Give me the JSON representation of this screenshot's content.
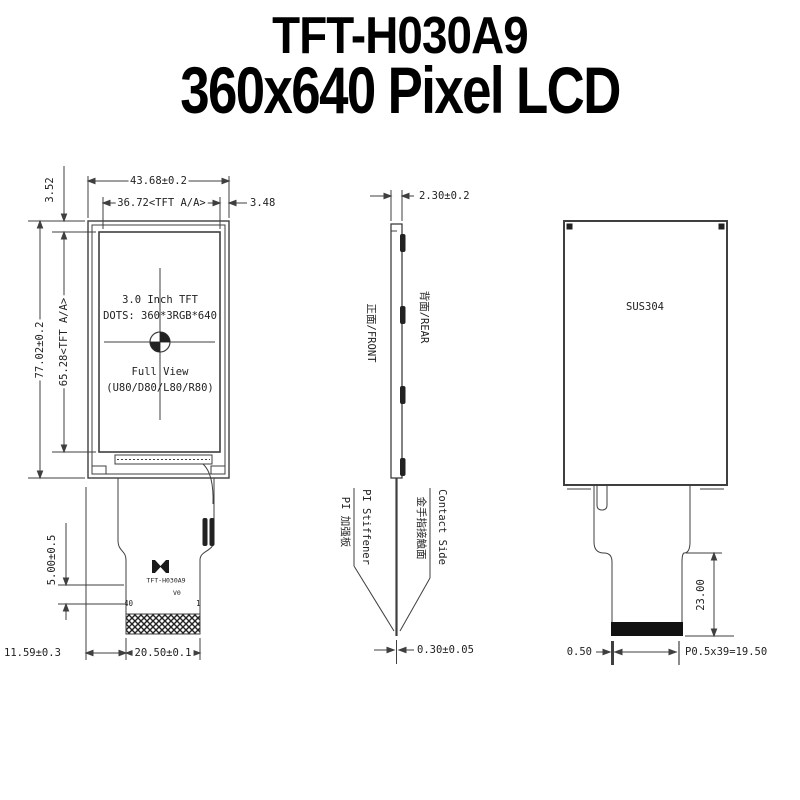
{
  "title": {
    "line1": "TFT-H030A9",
    "line2": "360x640 Pixel LCD"
  },
  "colors": {
    "background": "#ffffff",
    "line": "#3f3f3f",
    "text": "#222222",
    "title": "#000000"
  },
  "front_view": {
    "dim_width_outer": "43.68±0.2",
    "dim_width_aa": "36.72<TFT A/A>",
    "dim_gap_right": "3.48",
    "dim_gap_top": "3.52",
    "dim_height_outer": "77.02±0.2",
    "dim_height_aa": "65.28<TFT A/A>",
    "dim_fpc_drop": "5.00±0.5",
    "dim_bottom_offset": "11.59±0.3",
    "dim_connector_width": "20.50±0.1",
    "screen_line1": "3.0 Inch TFT",
    "screen_line2": "DOTS: 360*3RGB*640",
    "screen_line3": "Full View",
    "screen_line4": "(U80/D80/L80/R80)",
    "fpc_model": "TFT-H030A9",
    "fpc_version": "V0",
    "pin_left": "40",
    "pin_right": "1"
  },
  "side_view": {
    "dim_thickness": "2.30±0.2",
    "label_front": "正面/FRONT",
    "label_rear": "背面/REAR",
    "label_stiffener_en": "PI Stiffener",
    "label_stiffener_cn": "PI 加强板",
    "label_contact_en": "Contact Side",
    "label_contact_cn": "金手指接触面",
    "dim_fpc_thickness": "0.30±0.05"
  },
  "rear_view": {
    "material": "SUS304",
    "dim_tail_length": "23.00",
    "dim_pin_edge": "0.50",
    "dim_pitch": "P0.5x39=19.50"
  }
}
